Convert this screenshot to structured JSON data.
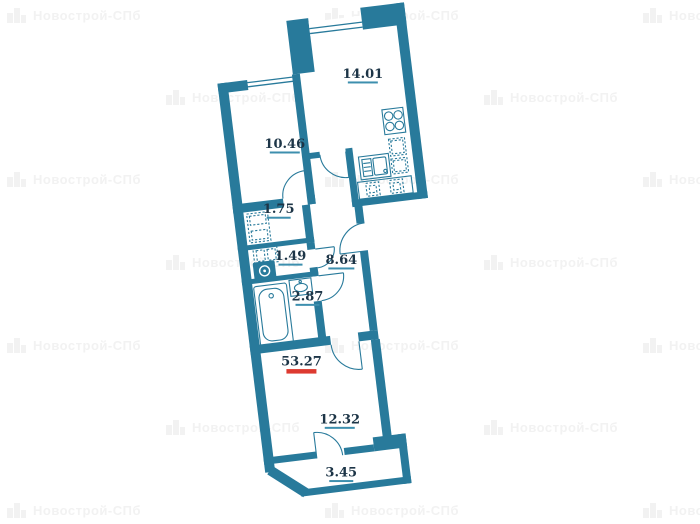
{
  "watermark": {
    "text": "Новострой-СПб",
    "color": "#f2f2f2",
    "positions": [
      [
        7,
        13
      ],
      [
        325,
        13
      ],
      [
        643,
        13
      ],
      [
        166,
        95
      ],
      [
        484,
        95
      ],
      [
        7,
        177
      ],
      [
        325,
        177
      ],
      [
        643,
        177
      ],
      [
        166,
        260
      ],
      [
        484,
        260
      ],
      [
        7,
        343
      ],
      [
        325,
        343
      ],
      [
        643,
        343
      ],
      [
        166,
        425
      ],
      [
        484,
        425
      ],
      [
        7,
        508
      ],
      [
        325,
        508
      ],
      [
        643,
        508
      ]
    ]
  },
  "plan": {
    "wall_color": "#287a9b",
    "label_color": "#1d3547",
    "underline_color": "#3d8fae",
    "total_underline_color": "#dd3a30",
    "rooms": [
      {
        "id": "kitchen",
        "area": "14.01",
        "x": 370,
        "y": 80,
        "w": 30,
        "total": false
      },
      {
        "id": "living-room",
        "area": "10.46",
        "x": 284,
        "y": 140,
        "w": 30,
        "total": false
      },
      {
        "id": "storage",
        "area": "1.75",
        "x": 270,
        "y": 204,
        "w": 24,
        "total": false
      },
      {
        "id": "wc",
        "area": "1.49",
        "x": 276,
        "y": 252,
        "w": 24,
        "total": false
      },
      {
        "id": "hallway",
        "area": "8.64",
        "x": 326,
        "y": 262,
        "w": 26,
        "total": false
      },
      {
        "id": "bathroom",
        "area": "2.87",
        "x": 288,
        "y": 294,
        "w": 24,
        "total": false
      },
      {
        "id": "total",
        "area": "53.27",
        "x": 274,
        "y": 358,
        "w": 30,
        "total": true
      },
      {
        "id": "room",
        "area": "12.32",
        "x": 305,
        "y": 420,
        "w": 30,
        "total": false
      },
      {
        "id": "balcony",
        "area": "3.45",
        "x": 300,
        "y": 473,
        "w": 24,
        "total": false
      }
    ]
  }
}
